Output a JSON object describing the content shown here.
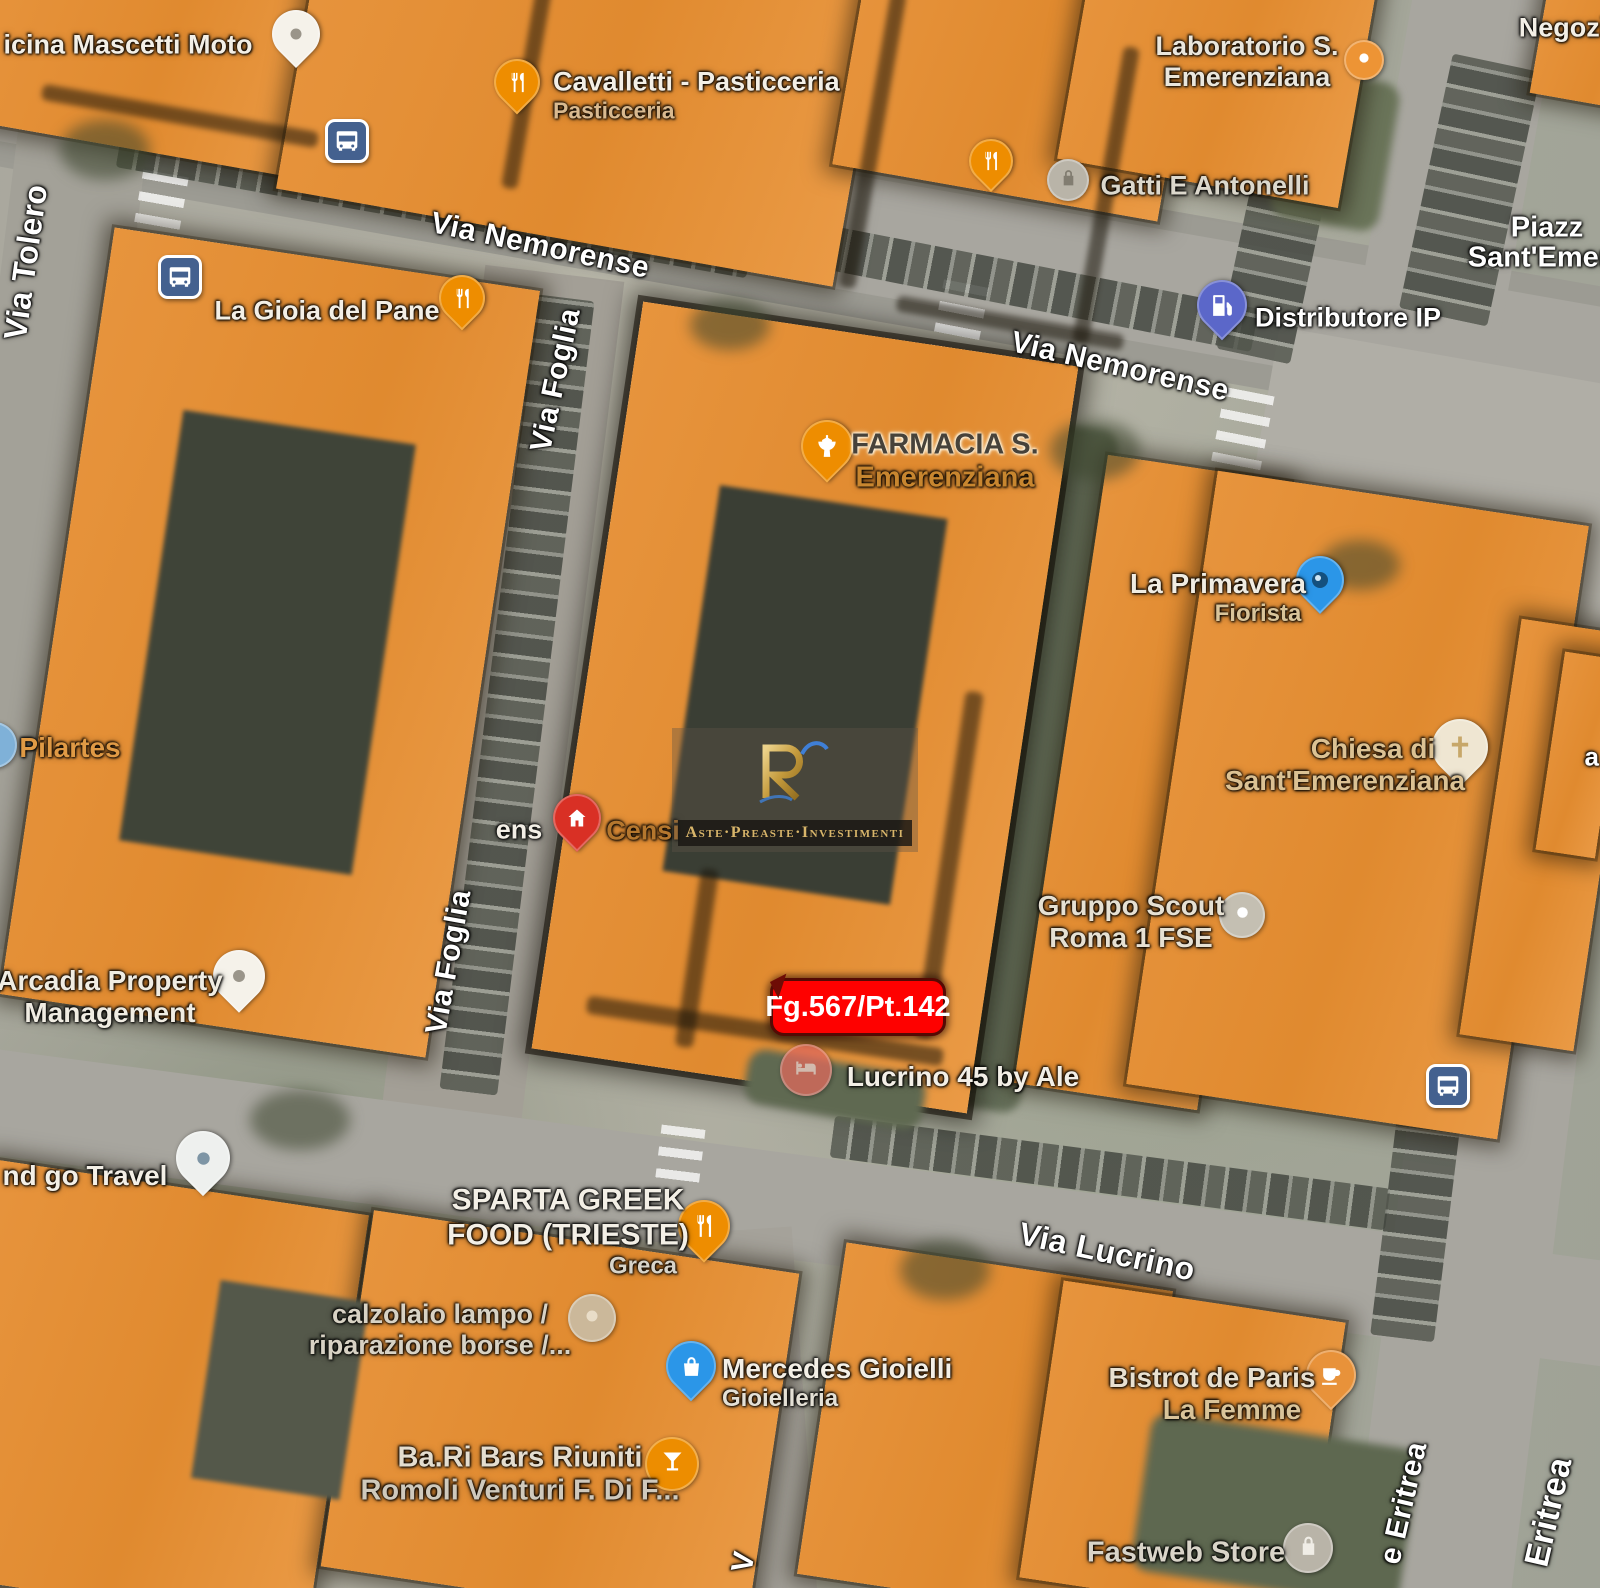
{
  "map": {
    "overlay_color": "#E7943D",
    "parcel_badge": {
      "text": "Fg.567/Pt.142",
      "bg": "#FE0100",
      "text_color": "#ffffff"
    },
    "watermark": {
      "monogram": "RI",
      "tagline": "Aste·Preaste·Investimenti",
      "gold": "#d8b56a",
      "blue": "#3f7fd6"
    },
    "street_labels": [
      {
        "text": "Via Nemorense",
        "x": 540,
        "y": 246,
        "rot": 12,
        "size": 30
      },
      {
        "text": "Via Nemorense",
        "x": 1120,
        "y": 367,
        "rot": 13,
        "size": 30
      },
      {
        "text": "Via Tolero",
        "x": 26,
        "y": 262,
        "rot": -82,
        "size": 32
      },
      {
        "text": "Via Foglia",
        "x": 556,
        "y": 380,
        "rot": -78,
        "size": 30
      },
      {
        "text": "Via Foglia",
        "x": 449,
        "y": 962,
        "rot": -80,
        "size": 30
      },
      {
        "text": "Via Lucrino",
        "x": 1107,
        "y": 1252,
        "rot": 12,
        "size": 32
      },
      {
        "text": "e Eritrea",
        "x": 1404,
        "y": 1503,
        "rot": -77,
        "size": 30
      },
      {
        "text": "Eritrea",
        "x": 1549,
        "y": 1512,
        "rot": -77,
        "size": 34
      },
      {
        "text": "V",
        "x": 744,
        "y": 1562,
        "rot": -80,
        "size": 30
      },
      {
        "text": "a",
        "x": 1592,
        "y": 757,
        "rot": 0,
        "size": 26
      }
    ],
    "poi_labels": [
      {
        "name": "officina-mascetti-moto",
        "x": 128,
        "y": 45,
        "lines": [
          {
            "t": "icina Mascetti Moto",
            "c": "#f3efe6",
            "s": 27
          }
        ],
        "icon": {
          "shape": "pin",
          "glyph": "dot",
          "color": "#f5f2ea",
          "gc": "#9a958a",
          "x": 296,
          "y": 40,
          "size": 48
        }
      },
      {
        "name": "cavalletti-pasticceria",
        "x": 553,
        "y": 95,
        "align": "left",
        "lines": [
          {
            "t": "Cavalletti - Pasticceria",
            "c": "#f3efe6",
            "s": 27
          },
          {
            "t": "Pasticceria",
            "c": "#d9b98f",
            "s": 23
          }
        ],
        "icon": {
          "shape": "pin",
          "glyph": "fork",
          "color": "#EE8D00",
          "gc": "#ffffff",
          "x": 517,
          "y": 88,
          "size": 46
        }
      },
      {
        "name": "laboratorio-s-emerenziana",
        "x": 1247,
        "y": 62,
        "lines": [
          {
            "t": "Laboratorio S.",
            "c": "#eae6dc",
            "s": 27
          },
          {
            "t": "Emerenziana",
            "c": "#eae6dc",
            "s": 27
          }
        ],
        "icon": {
          "shape": "circle",
          "glyph": "dot",
          "color": "#ED9435",
          "gc": "#ffffff",
          "x": 1364,
          "y": 60,
          "size": 40
        }
      },
      {
        "name": "negozi",
        "x": 1563,
        "y": 28,
        "lines": [
          {
            "t": "Negozi",
            "c": "#f3efe6",
            "s": 27
          }
        ]
      },
      {
        "name": "gatti-e-antonelli",
        "x": 1205,
        "y": 186,
        "lines": [
          {
            "t": "Gatti E Antonelli",
            "c": "#dcd8cc",
            "s": 27
          }
        ],
        "icon": {
          "shape": "pin",
          "glyph": "fork",
          "color": "#EE8D00",
          "gc": "#ffffff",
          "x": 991,
          "y": 166,
          "size": 44
        },
        "icon2": {
          "shape": "circle",
          "glyph": "lock",
          "color": "#b9b4a8",
          "gc": "#827d71",
          "x": 1068,
          "y": 180,
          "size": 42
        }
      },
      {
        "name": "piazza-sant-emerenziana-line1",
        "x": 1547,
        "y": 228,
        "lines": [
          {
            "t": "Piazz",
            "c": "#ffffff",
            "s": 29
          }
        ]
      },
      {
        "name": "piazza-sant-emerenziana-line2",
        "x": 1547,
        "y": 258,
        "lines": [
          {
            "t": "Sant'Emere",
            "c": "#ffffff",
            "s": 29
          }
        ]
      },
      {
        "name": "distributore-ip",
        "x": 1348,
        "y": 318,
        "lines": [
          {
            "t": "Distributore IP",
            "c": "#ffffff",
            "s": 27
          }
        ],
        "icon": {
          "shape": "pin",
          "glyph": "pump",
          "color": "#5b67c9",
          "gc": "#ffffff",
          "x": 1222,
          "y": 311,
          "size": 50
        }
      },
      {
        "name": "la-gioia-del-pane",
        "x": 327,
        "y": 311,
        "lines": [
          {
            "t": "La Gioia del Pane",
            "c": "#f3efe6",
            "s": 27
          }
        ],
        "icon": {
          "shape": "pin",
          "glyph": "fork",
          "color": "#EE8D00",
          "gc": "#ffffff",
          "x": 462,
          "y": 304,
          "size": 46
        }
      },
      {
        "name": "farmacia-s-emerenziana",
        "x": 945,
        "y": 462,
        "lines": [
          {
            "t": "FARMACIA S.",
            "c": "#47423a",
            "s": 29,
            "halo": "light"
          },
          {
            "t": "Emerenziana",
            "c": "#c8862f",
            "s": 29
          }
        ],
        "icon": {
          "shape": "pin",
          "glyph": "mortar",
          "color": "#EE8D00",
          "gc": "#ffffff",
          "x": 827,
          "y": 452,
          "size": 52
        }
      },
      {
        "name": "la-primavera-fiorista",
        "x": 1218,
        "y": 598,
        "lines": [
          {
            "t": "La Primavera",
            "c": "#f0ece2",
            "s": 28
          },
          {
            "t": "Fiorista",
            "c": "#d9c49a",
            "s": 24,
            "dx": 40
          }
        ],
        "icon": {
          "shape": "pin",
          "glyph": "photo",
          "color": "#2b96e8",
          "gc": "#14507e",
          "x": 1320,
          "y": 586,
          "size": 48
        }
      },
      {
        "name": "pilartes",
        "x": 70,
        "y": 748,
        "lines": [
          {
            "t": "Pilartes",
            "c": "#e09a45",
            "s": 28
          }
        ],
        "icon": {
          "shape": "circle",
          "glyph": "dot",
          "color": "#7fb1d8",
          "gc": "#ffffff",
          "x": -6,
          "y": 745,
          "size": 46
        }
      },
      {
        "name": "chiesa-di-sant-emerenziana",
        "x": 1345,
        "y": 765,
        "lines": [
          {
            "t": "Chiesa di",
            "c": "#dbc193",
            "s": 28,
            "dx": 28
          },
          {
            "t": "Sant'Emerenziana",
            "c": "#dbc193",
            "s": 28
          }
        ],
        "icon": {
          "shape": "pin",
          "glyph": "cross",
          "color": "#efe6d2",
          "gc": "#c7a769",
          "x": 1460,
          "y": 754,
          "size": 56
        }
      },
      {
        "name": "censi",
        "x": 643,
        "y": 831,
        "lines": [
          {
            "t": "Censi",
            "c": "#b5772e",
            "s": 27
          }
        ],
        "icon": {
          "shape": "pin",
          "glyph": "house",
          "color": "#D93025",
          "gc": "#ffffff",
          "x": 577,
          "y": 824,
          "size": 48
        }
      },
      {
        "name": "label-fragment-ens",
        "x": 519,
        "y": 830,
        "lines": [
          {
            "t": "ens",
            "c": "#f3efe6",
            "s": 27
          }
        ]
      },
      {
        "name": "gruppo-scout-roma-1-fse",
        "x": 1131,
        "y": 922,
        "lines": [
          {
            "t": "Gruppo Scout",
            "c": "#e6e0d2",
            "s": 28
          },
          {
            "t": "Roma 1 FSE",
            "c": "#e6e0d2",
            "s": 28
          }
        ],
        "icon": {
          "shape": "circle",
          "glyph": "dot",
          "color": "#c4bfb2",
          "gc": "#ffffff",
          "x": 1242,
          "y": 915,
          "size": 46
        }
      },
      {
        "name": "arcadia-property-management",
        "x": 110,
        "y": 997,
        "lines": [
          {
            "t": "Arcadia Property",
            "c": "#f0ece2",
            "s": 28
          },
          {
            "t": "Management",
            "c": "#f0ece2",
            "s": 28
          }
        ],
        "icon": {
          "shape": "pin",
          "glyph": "dot",
          "color": "#f5f2ea",
          "gc": "#9a958a",
          "x": 239,
          "y": 982,
          "size": 52
        }
      },
      {
        "name": "lucrino-45-by-ale",
        "x": 963,
        "y": 1077,
        "lines": [
          {
            "t": "Lucrino 45 by Ale",
            "c": "#f3efe6",
            "s": 28
          }
        ],
        "icon": {
          "shape": "circle",
          "glyph": "bed",
          "color": "#e0695c",
          "gc": "#f8d6ce",
          "x": 806,
          "y": 1070,
          "size": 52,
          "op": 0.75
        }
      },
      {
        "name": "and-go-travel",
        "x": 85,
        "y": 1176,
        "lines": [
          {
            "t": "nd go Travel",
            "c": "#f3efe6",
            "s": 28
          }
        ],
        "icon": {
          "shape": "pin",
          "glyph": "dot",
          "color": "#eef0ee",
          "gc": "#7e95a5",
          "x": 203,
          "y": 1164,
          "size": 54
        }
      },
      {
        "name": "sparta-greek-food",
        "x": 568,
        "y": 1232,
        "lines": [
          {
            "t": "SPARTA GREEK",
            "c": "#f3efe6",
            "s": 30
          },
          {
            "t": "FOOD (TRIESTE)",
            "c": "#f3efe6",
            "s": 30
          },
          {
            "t": "Greca",
            "c": "#d8d4c9",
            "s": 24,
            "dx": 75
          }
        ],
        "icon": {
          "shape": "pin",
          "glyph": "fork",
          "color": "#EE8D00",
          "gc": "#ffffff",
          "x": 704,
          "y": 1232,
          "size": 52
        }
      },
      {
        "name": "calzolaio-lampo",
        "x": 440,
        "y": 1330,
        "lines": [
          {
            "t": "calzolaio lampo /",
            "c": "#d8d2c4",
            "s": 27
          },
          {
            "t": "riparazione borse /...",
            "c": "#d8d2c4",
            "s": 27
          }
        ],
        "icon": {
          "shape": "circle",
          "glyph": "dot",
          "color": "#cbb89a",
          "gc": "#e9ddc8",
          "x": 592,
          "y": 1318,
          "size": 48
        }
      },
      {
        "name": "mercedes-gioielli",
        "x": 722,
        "y": 1383,
        "align": "left",
        "lines": [
          {
            "t": "Mercedes Gioielli",
            "c": "#f3efe6",
            "s": 28
          },
          {
            "t": "Gioielleria",
            "c": "#e4e0d5",
            "s": 24
          }
        ],
        "icon": {
          "shape": "pin",
          "glyph": "bag",
          "color": "#2b96e8",
          "gc": "#ffffff",
          "x": 691,
          "y": 1372,
          "size": 50
        }
      },
      {
        "name": "bistrot-de-paris-la-femme",
        "x": 1212,
        "y": 1394,
        "lines": [
          {
            "t": "Bistrot de Paris",
            "c": "#e8e0d0",
            "s": 28
          },
          {
            "t": "La Femme",
            "c": "#d9c49a",
            "s": 28,
            "dx": 20
          }
        ],
        "icon": {
          "shape": "pin",
          "glyph": "cup",
          "color": "#e8923a",
          "gc": "#ffffff",
          "x": 1331,
          "y": 1381,
          "size": 50
        }
      },
      {
        "name": "ba-ri-bars-riuniti",
        "x": 520,
        "y": 1475,
        "lines": [
          {
            "t": "Ba.Ri Bars Riuniti",
            "c": "#e4ddcf",
            "s": 29
          },
          {
            "t": "Romoli Venturi F. Di F...",
            "c": "#cfc9bc",
            "s": 29
          }
        ],
        "icon": {
          "shape": "circle",
          "glyph": "martini",
          "color": "#ED8D00",
          "gc": "#ffffff",
          "x": 672,
          "y": 1464,
          "size": 54
        }
      },
      {
        "name": "fastweb-store",
        "x": 1186,
        "y": 1553,
        "lines": [
          {
            "t": "Fastweb Store",
            "c": "#d9d4c8",
            "s": 29
          }
        ],
        "icon": {
          "shape": "circle",
          "glyph": "lock",
          "color": "#b9b4a8",
          "gc": "#f0ede6",
          "x": 1308,
          "y": 1548,
          "size": 50
        }
      }
    ],
    "transit_icons": [
      {
        "x": 346,
        "y": 140
      },
      {
        "x": 179,
        "y": 276
      },
      {
        "x": 1447,
        "y": 1085
      }
    ]
  }
}
